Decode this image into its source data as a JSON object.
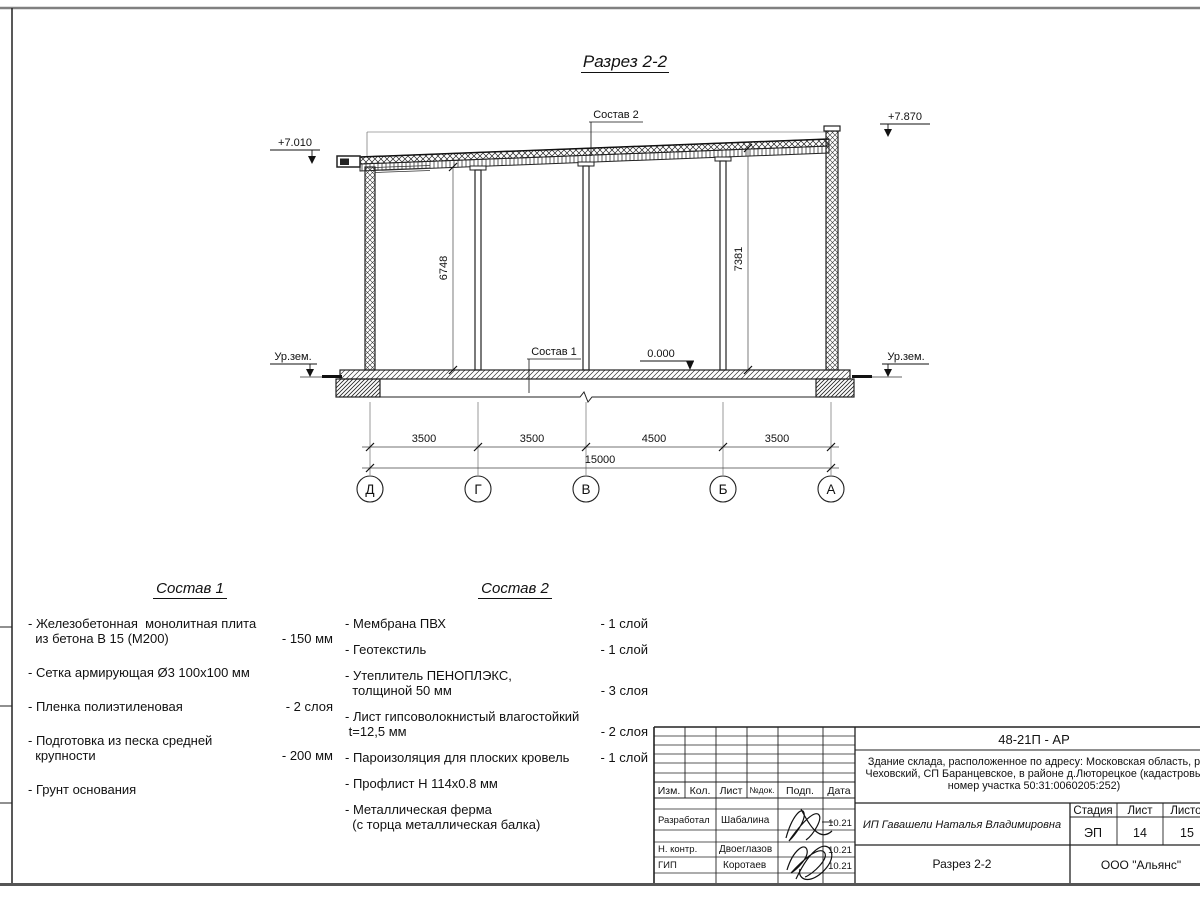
{
  "sheet": {
    "title": "Разрез 2-2"
  },
  "drawing": {
    "elevation_left": "+7.010",
    "elevation_right": "+7.870",
    "label_sostav2": "Состав 2",
    "label_sostav1": "Состав 1",
    "label_zero": "0.000",
    "ground_label": "Ур.зем.",
    "dim_left": "6748",
    "dim_right": "7381",
    "spans": [
      "3500",
      "3500",
      "4500",
      "3500"
    ],
    "total": "15000",
    "axes": [
      "Д",
      "Г",
      "В",
      "Б",
      "А"
    ]
  },
  "sostav1": {
    "title": "Состав 1",
    "items": [
      {
        "name": "- Железобетонная  монолитная плита\n  из бетона В 15 (М200)",
        "value": "- 150 мм"
      },
      {
        "name": "- Сетка армирующая Ø3 100х100 мм",
        "value": ""
      },
      {
        "name": "- Пленка полиэтиленовая",
        "value": "-  2 слоя"
      },
      {
        "name": "- Подготовка из песка средней\n  крупности",
        "value": "- 200 мм"
      },
      {
        "name": "- Грунт основания",
        "value": ""
      }
    ]
  },
  "sostav2": {
    "title": "Состав 2",
    "items": [
      {
        "name": "- Мембрана ПВХ",
        "value": "- 1 слой"
      },
      {
        "name": "- Геотекстиль",
        "value": "- 1 слой"
      },
      {
        "name": "- Утеплитель ПЕНОПЛЭКС,\n  толщиной 50 мм",
        "value": "- 3 слоя"
      },
      {
        "name": "- Лист гипсоволокнистый влагостойкий\n t=12,5 мм",
        "value": "- 2 слоя"
      },
      {
        "name": "- Пароизоляция для плоских кровель",
        "value": "- 1 слой"
      },
      {
        "name": "- Профлист Н 114х0.8 мм",
        "value": ""
      },
      {
        "name": "- Металлическая ферма\n  (с торца металлическая балка)",
        "value": ""
      }
    ]
  },
  "titleblock": {
    "code": "48-21П - АР",
    "description_lines": [
      "Здание склада, расположенное по адресу: Московская область, р",
      "Чеховский, СП Баранцевское, в районе д.Люторецкое  (кадастровы",
      "номер участка 50:31:0060205:252)"
    ],
    "header_cols": [
      "Изм.",
      "Кол.",
      "Лист",
      "№док.",
      "Подп.",
      "Дата"
    ],
    "rows": [
      {
        "role": "Разработал",
        "name": "Шабалина",
        "date": "10.21"
      },
      {
        "role": "Н. контр.",
        "name": "Двоеглазов",
        "date": "10.21"
      },
      {
        "role": "ГИП",
        "name": "Коротаев",
        "date": "10.21"
      }
    ],
    "client": "ИП Гавашели Наталья Владимировна",
    "stage_label": "Стадия",
    "sheet_label": "Лист",
    "sheets_label": "Листов",
    "stage": "ЭП",
    "sheet_num": "14",
    "sheets_total": "15",
    "drawing_name": "Разрез 2-2",
    "company": "ООО \"Альянс\""
  }
}
